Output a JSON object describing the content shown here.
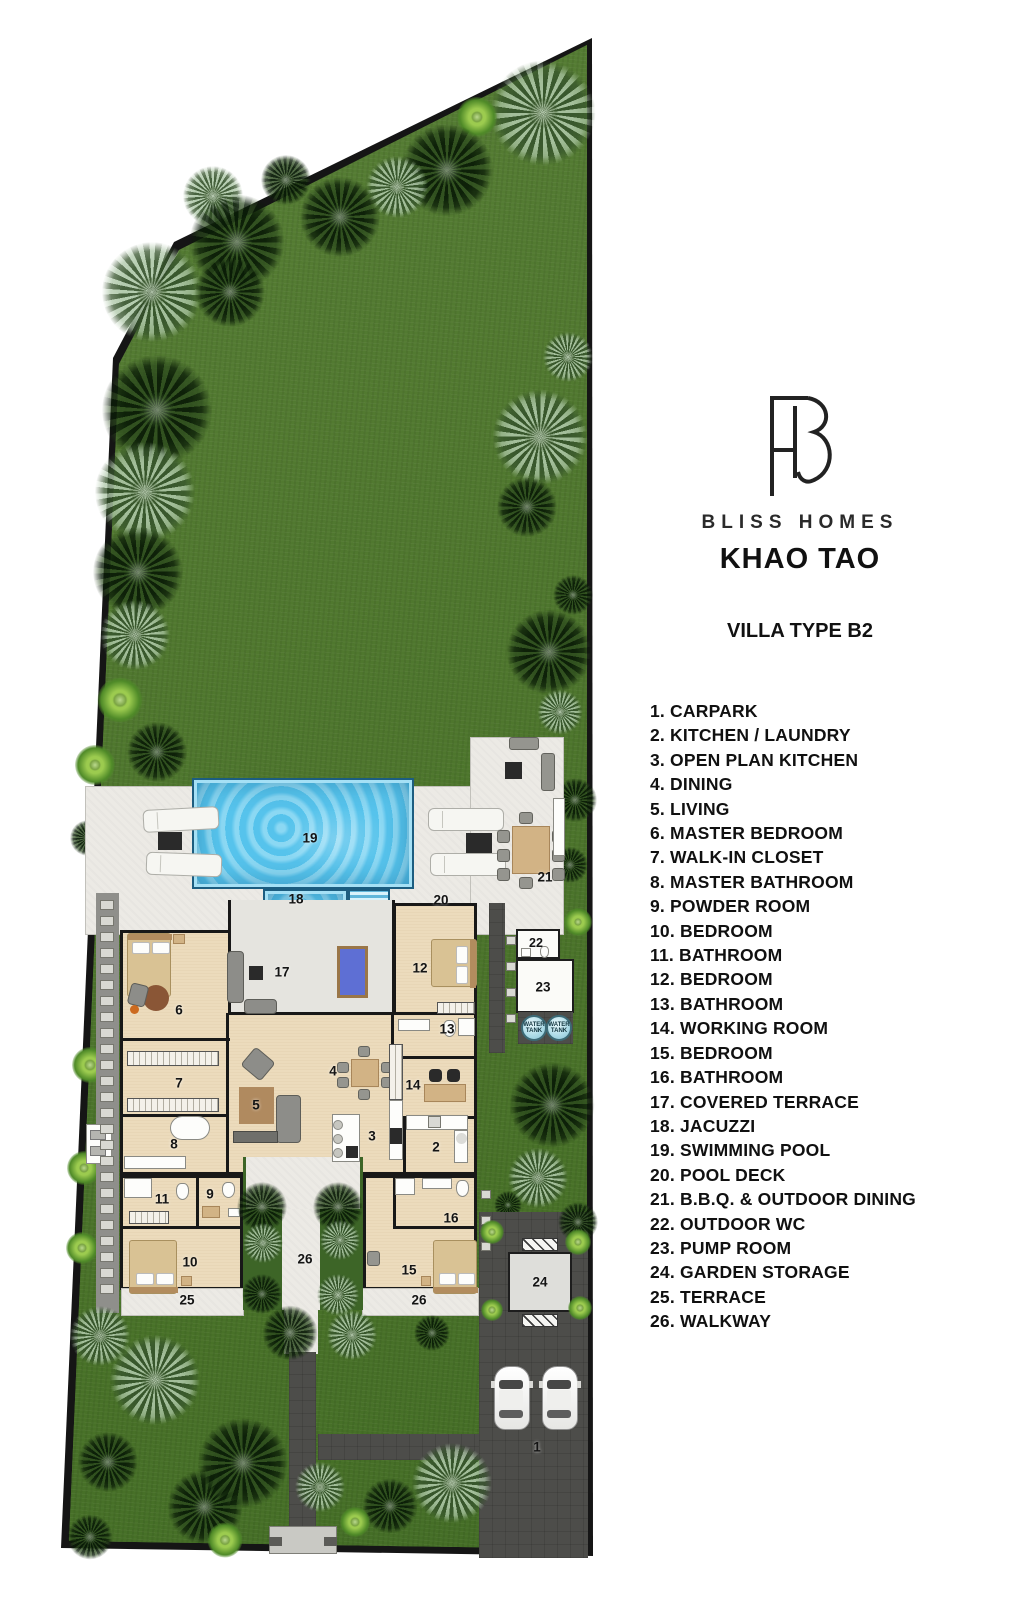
{
  "branding": {
    "company": "BLISS HOMES",
    "project": "KHAO TAO",
    "villa_type": "VILLA TYPE B2"
  },
  "legend": {
    "items": [
      "1. CARPARK",
      "2. KITCHEN / LAUNDRY",
      "3. OPEN PLAN KITCHEN",
      "4. DINING",
      "5. LIVING",
      "6. MASTER BEDROOM",
      "7. WALK-IN CLOSET",
      "8. MASTER BATHROOM",
      "9. POWDER ROOM",
      "10. BEDROOM",
      "11. BATHROOM",
      "12. BEDROOM",
      "13. BATHROOM",
      "14. WORKING ROOM",
      "15. BEDROOM",
      "16. BATHROOM",
      "17. COVERED TERRACE",
      "18. JACUZZI",
      "19. SWIMMING POOL",
      "20. POOL DECK",
      "21. B.B.Q. & OUTDOOR DINING",
      "22. OUTDOOR WC",
      "23. PUMP ROOM",
      "24. GARDEN STORAGE",
      "25. TERRACE",
      "26. WALKWAY"
    ]
  },
  "plan": {
    "labels": {
      "1": "1",
      "2": "2",
      "3": "3",
      "4": "4",
      "5": "5",
      "6": "6",
      "7": "7",
      "8": "8",
      "9": "9",
      "10": "10",
      "11": "11",
      "12": "12",
      "13": "13",
      "14": "14",
      "15": "15",
      "16": "16",
      "17": "17",
      "18": "18",
      "19": "19",
      "20": "20",
      "21": "21",
      "22": "22",
      "23": "23",
      "24": "24",
      "25": "25",
      "26": "26"
    },
    "water_tank": {
      "line1": "WATER",
      "line2": "TANK"
    }
  },
  "colors": {
    "grass": "#4c7830",
    "pool": "#5ec9ef",
    "deck": "#eceae5",
    "floor": "#ecdbbc",
    "paving": "#4d4d4a",
    "wall": "#181818"
  }
}
